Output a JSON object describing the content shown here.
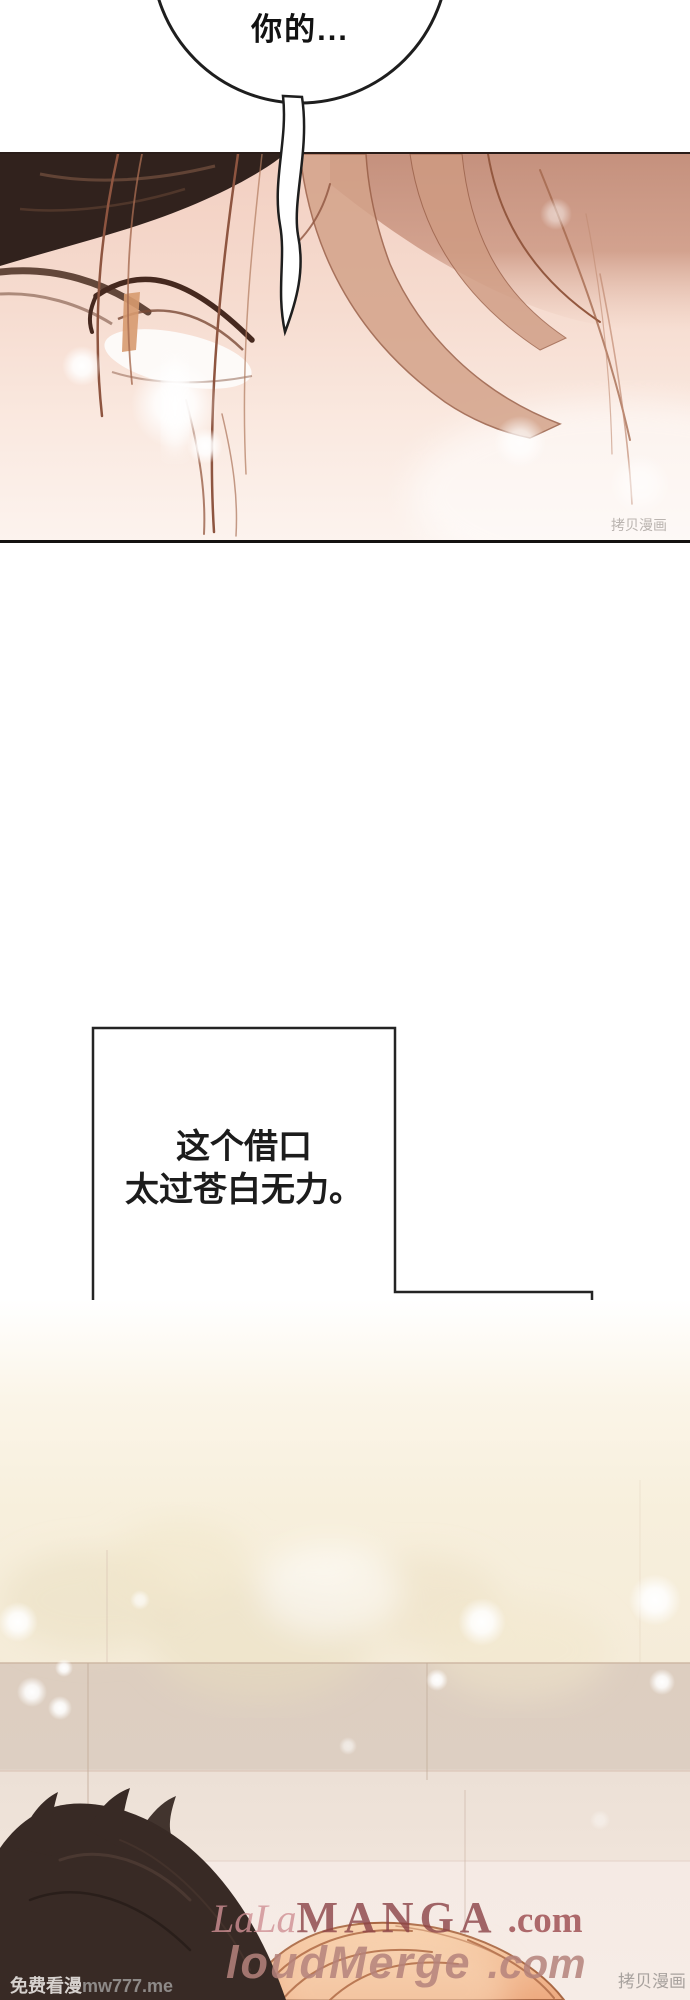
{
  "speech_bubble": {
    "text": "你的..."
  },
  "caption_box_top": {
    "line1": "这个借口",
    "line2": "太过苍白无力。"
  },
  "caption_box_bottom": {
    "line1": "连我听着都",
    "line2": "觉得心虚。"
  },
  "watermarks": {
    "panel_corner": "拷贝漫画",
    "bottom_right": "拷贝漫画",
    "bottom_left_cn": "免费看漫",
    "bottom_left_url": "mw777.me",
    "site1_script": "LaLa",
    "site1_caps": "MANGA",
    "site1_suffix": ".com",
    "site2_name": "loudMerge",
    "site2_suffix": ".com"
  },
  "colors": {
    "caption_text": "#1c1c1c",
    "caption_bottom_line1": "#8b6260",
    "caption_bottom_line2": "#a5716d",
    "watermark_maroon": "#8c4347",
    "watermark_rose": "#b5837c",
    "panel_skin": "#f2cfc1",
    "hair_dark": "#31221d",
    "hair_tan": "#d4a38a",
    "wall_cream": "#f5ecd9",
    "wall_band": "#ddcec0"
  }
}
